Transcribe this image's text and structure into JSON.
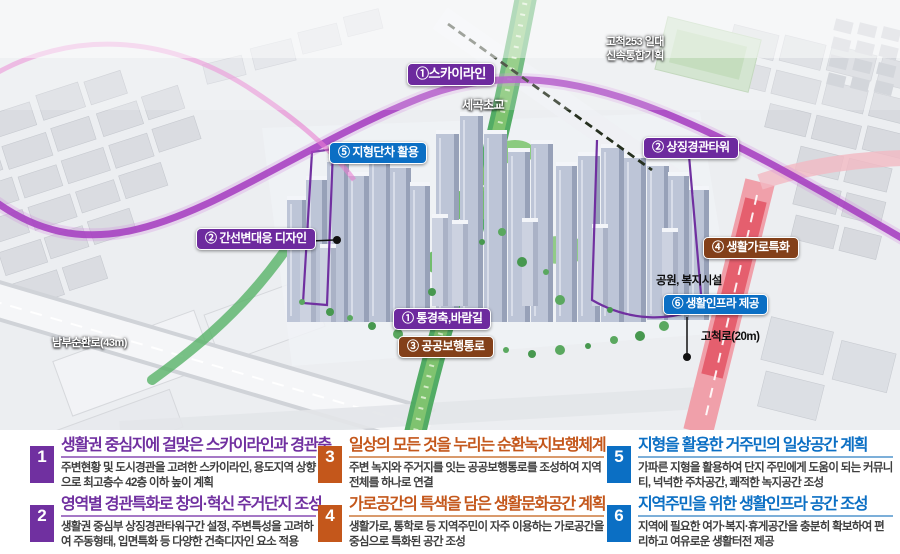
{
  "scene": {
    "area_note_line1": "고척253 일대",
    "area_note_line2": "신속통합기획",
    "school_label": "세곡초교",
    "park_facility_label": "공원, 복지시설",
    "road_right_label": "고척로(20m)",
    "road_left_label": "남부순환로(43m)",
    "callouts": [
      {
        "id": "skyline",
        "label": "①스카이라인",
        "color": "#6d2a9e"
      },
      {
        "id": "terrace-use",
        "label": "⑤ 지형단차 활용",
        "color": "#0b6fc4"
      },
      {
        "id": "landmark-tower",
        "label": "② 상징경관타워",
        "color": "#6d2a9e"
      },
      {
        "id": "arterial-design",
        "label": "② 간선변대응 디자인",
        "color": "#6d2a9e"
      },
      {
        "id": "living-street",
        "label": "④ 생활가로특화",
        "color": "#83401a"
      },
      {
        "id": "view-axis",
        "label": "① 통경축,바람길",
        "color": "#6d2a9e"
      },
      {
        "id": "public-walkway",
        "label": "③ 공공보행통로",
        "color": "#83401a"
      },
      {
        "id": "living-infra",
        "label": "⑥ 생활인프라 제공",
        "color": "#0b6fc4"
      }
    ]
  },
  "legend": {
    "blocks": [
      {
        "num": "1",
        "title": "생활권 중심지에 걸맞은 스카이라인과 경관축",
        "body": "주변현황 및 도시경관을 고려한 스카이라인, 용도지역 상향으로 최고층수 42층 이하 높이 계획",
        "accent": "#7030a0"
      },
      {
        "num": "2",
        "title": "영역별 경관특화로 창의·혁신 주거단지 조성",
        "body": "생활권 중심부 상징경관타워구간 설정, 주변특성을 고려하여 주동형태, 입면특화 등 다양한 건축디자인 요소 적용",
        "accent": "#7030a0"
      },
      {
        "num": "3",
        "title": "일상의 모든 것을 누리는 순환녹지보행체계",
        "body": "주변 녹지와 주거지를 잇는 공공보행통로를 조성하여 지역 전체를 하나로 연결",
        "accent": "#c4571b"
      },
      {
        "num": "4",
        "title": "가로공간의 특색을 담은 생활문화공간 계획",
        "body": "생활가로, 통학로 등 지역주민이 자주 이용하는 가로공간을 중심으로 특화된 공간 조성",
        "accent": "#c4571b"
      },
      {
        "num": "5",
        "title": "지형을 활용한 거주민의 일상공간 계획",
        "body": "가파른 지형을 활용하여 단지 주민에게 도움이 되는 커뮤니티, 넉넉한 주차공간, 쾌적한 녹지공간 조성",
        "accent": "#0b6fc4"
      },
      {
        "num": "6",
        "title": "지역주민을 위한 생활인프라 공간 조성",
        "body": "지역에 필요한 여가·복지·휴게공간을 충분히 확보하여 편리하고 여유로운 생활터전 제공",
        "accent": "#0b6fc4"
      }
    ]
  }
}
